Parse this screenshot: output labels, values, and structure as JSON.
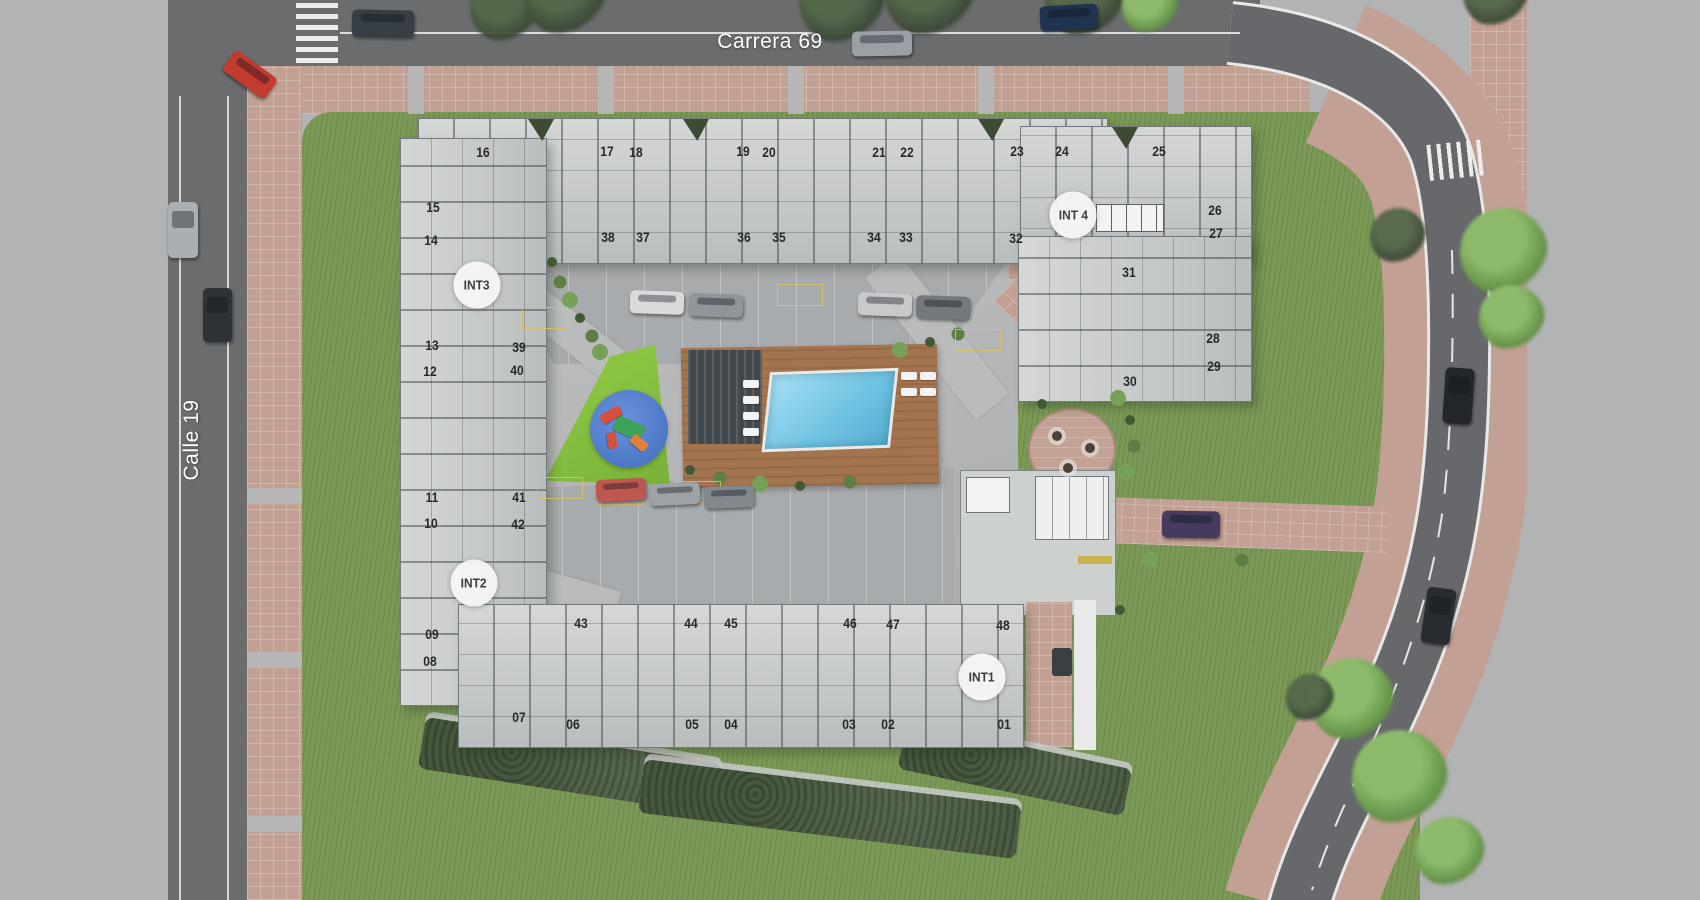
{
  "streets": {
    "top_label": "Carrera 69",
    "left_label": "Calle 19"
  },
  "int_markers": [
    {
      "label": "INT3",
      "x": 477,
      "y": 285
    },
    {
      "label": "INT 4",
      "x": 1073,
      "y": 215
    },
    {
      "label": "INT2",
      "x": 474,
      "y": 583
    },
    {
      "label": "INT1",
      "x": 982,
      "y": 677
    }
  ],
  "units": [
    {
      "n": "16",
      "x": 483,
      "y": 152
    },
    {
      "n": "17",
      "x": 607,
      "y": 151
    },
    {
      "n": "18",
      "x": 636,
      "y": 152
    },
    {
      "n": "19",
      "x": 743,
      "y": 151
    },
    {
      "n": "20",
      "x": 769,
      "y": 152
    },
    {
      "n": "21",
      "x": 879,
      "y": 152
    },
    {
      "n": "22",
      "x": 907,
      "y": 152
    },
    {
      "n": "23",
      "x": 1017,
      "y": 151
    },
    {
      "n": "24",
      "x": 1062,
      "y": 151
    },
    {
      "n": "25",
      "x": 1159,
      "y": 151
    },
    {
      "n": "38",
      "x": 608,
      "y": 237
    },
    {
      "n": "37",
      "x": 643,
      "y": 237
    },
    {
      "n": "36",
      "x": 744,
      "y": 237
    },
    {
      "n": "35",
      "x": 779,
      "y": 237
    },
    {
      "n": "34",
      "x": 874,
      "y": 237
    },
    {
      "n": "33",
      "x": 906,
      "y": 237
    },
    {
      "n": "32",
      "x": 1016,
      "y": 238
    },
    {
      "n": "26",
      "x": 1215,
      "y": 210
    },
    {
      "n": "27",
      "x": 1216,
      "y": 233
    },
    {
      "n": "31",
      "x": 1129,
      "y": 272
    },
    {
      "n": "28",
      "x": 1213,
      "y": 338
    },
    {
      "n": "29",
      "x": 1214,
      "y": 366
    },
    {
      "n": "30",
      "x": 1130,
      "y": 381
    },
    {
      "n": "15",
      "x": 433,
      "y": 207
    },
    {
      "n": "14",
      "x": 431,
      "y": 240
    },
    {
      "n": "13",
      "x": 432,
      "y": 345
    },
    {
      "n": "12",
      "x": 430,
      "y": 371
    },
    {
      "n": "39",
      "x": 519,
      "y": 347
    },
    {
      "n": "40",
      "x": 517,
      "y": 370
    },
    {
      "n": "11",
      "x": 432,
      "y": 497
    },
    {
      "n": "10",
      "x": 431,
      "y": 523
    },
    {
      "n": "41",
      "x": 519,
      "y": 497
    },
    {
      "n": "42",
      "x": 518,
      "y": 524
    },
    {
      "n": "09",
      "x": 432,
      "y": 634
    },
    {
      "n": "08",
      "x": 430,
      "y": 661
    },
    {
      "n": "43",
      "x": 581,
      "y": 623
    },
    {
      "n": "44",
      "x": 691,
      "y": 623
    },
    {
      "n": "45",
      "x": 731,
      "y": 623
    },
    {
      "n": "46",
      "x": 850,
      "y": 623
    },
    {
      "n": "47",
      "x": 893,
      "y": 624
    },
    {
      "n": "48",
      "x": 1003,
      "y": 625
    },
    {
      "n": "07",
      "x": 519,
      "y": 717
    },
    {
      "n": "06",
      "x": 573,
      "y": 724
    },
    {
      "n": "05",
      "x": 692,
      "y": 724
    },
    {
      "n": "04",
      "x": 731,
      "y": 724
    },
    {
      "n": "03",
      "x": 849,
      "y": 724
    },
    {
      "n": "02",
      "x": 888,
      "y": 724
    },
    {
      "n": "01",
      "x": 1004,
      "y": 724
    }
  ],
  "cars": [
    {
      "x": 352,
      "y": 10,
      "w": 62,
      "h": 27,
      "r": 1,
      "c": "#383e45"
    },
    {
      "x": 852,
      "y": 31,
      "w": 60,
      "h": 25,
      "r": -1,
      "c": "#9aa0a5"
    },
    {
      "x": 1040,
      "y": 5,
      "w": 58,
      "h": 25,
      "r": -3,
      "c": "#20334f"
    },
    {
      "x": 224,
      "y": 62,
      "w": 52,
      "h": 25,
      "r": 36,
      "c": "#c23b2e"
    },
    {
      "x": 168,
      "y": 202,
      "w": 30,
      "h": 56,
      "r": 0,
      "c": "#a9afb3"
    },
    {
      "x": 203,
      "y": 288,
      "w": 29,
      "h": 54,
      "r": 0,
      "c": "#2d3237"
    },
    {
      "x": 1444,
      "y": 368,
      "w": 29,
      "h": 56,
      "r": 4,
      "c": "#23272b"
    },
    {
      "x": 1424,
      "y": 588,
      "w": 29,
      "h": 56,
      "r": 8,
      "c": "#282c31"
    },
    {
      "x": 1162,
      "y": 511,
      "w": 58,
      "h": 27,
      "r": 1,
      "c": "#463b5e"
    },
    {
      "x": 630,
      "y": 291,
      "w": 54,
      "h": 23,
      "r": 2,
      "c": "#d8dadb"
    },
    {
      "x": 689,
      "y": 294,
      "w": 54,
      "h": 23,
      "r": 2,
      "c": "#8f9599"
    },
    {
      "x": 858,
      "y": 293,
      "w": 54,
      "h": 23,
      "r": 2,
      "c": "#c7c9cb"
    },
    {
      "x": 916,
      "y": 296,
      "w": 54,
      "h": 23,
      "r": 2,
      "c": "#75797d"
    },
    {
      "x": 596,
      "y": 479,
      "w": 50,
      "h": 22,
      "r": -3,
      "c": "#bf5750"
    },
    {
      "x": 650,
      "y": 483,
      "w": 50,
      "h": 22,
      "r": -3,
      "c": "#9ea3a7"
    },
    {
      "x": 704,
      "y": 486,
      "w": 50,
      "h": 22,
      "r": -2,
      "c": "#83888c"
    }
  ],
  "trees": [
    {
      "x": 505,
      "y": 8,
      "s": 70,
      "t": "dark"
    },
    {
      "x": 565,
      "y": -6,
      "s": 84,
      "t": "dark"
    },
    {
      "x": 842,
      "y": 2,
      "s": 86,
      "t": "dark"
    },
    {
      "x": 930,
      "y": -8,
      "s": 92,
      "t": "dark"
    },
    {
      "x": 1085,
      "y": -2,
      "s": 80,
      "t": "dark"
    },
    {
      "x": 1150,
      "y": 6,
      "s": 56,
      "t": "light"
    },
    {
      "x": 1496,
      "y": -6,
      "s": 66,
      "t": "dark"
    },
    {
      "x": 1504,
      "y": 252,
      "s": 88,
      "t": "light"
    },
    {
      "x": 1512,
      "y": 318,
      "s": 66,
      "t": "light"
    },
    {
      "x": 1398,
      "y": 236,
      "s": 56,
      "t": "dark"
    },
    {
      "x": 1352,
      "y": 700,
      "s": 84,
      "t": "light"
    },
    {
      "x": 1400,
      "y": 778,
      "s": 96,
      "t": "light"
    },
    {
      "x": 1310,
      "y": 698,
      "s": 48,
      "t": "dark"
    },
    {
      "x": 1450,
      "y": 852,
      "s": 70,
      "t": "light"
    }
  ],
  "shrubs": [
    [
      552,
      262
    ],
    [
      560,
      282
    ],
    [
      570,
      300
    ],
    [
      580,
      318
    ],
    [
      592,
      336
    ],
    [
      600,
      352
    ],
    [
      690,
      470
    ],
    [
      720,
      478
    ],
    [
      760,
      484
    ],
    [
      800,
      486
    ],
    [
      850,
      482
    ],
    [
      900,
      350
    ],
    [
      930,
      342
    ],
    [
      958,
      334
    ],
    [
      1118,
      398
    ],
    [
      1130,
      420
    ],
    [
      1134,
      446
    ],
    [
      1126,
      472
    ],
    [
      1042,
      404
    ],
    [
      1242,
      560
    ],
    [
      1150,
      560
    ],
    [
      1120,
      610
    ]
  ],
  "stalls": [
    [
      545,
      318
    ],
    [
      800,
      295
    ],
    [
      978,
      340
    ],
    [
      620,
      494
    ],
    [
      698,
      492
    ],
    [
      560,
      488
    ]
  ],
  "loungers": [
    [
      743,
      380
    ],
    [
      743,
      396
    ],
    [
      743,
      412
    ],
    [
      743,
      428
    ],
    [
      901,
      372
    ],
    [
      920,
      372
    ],
    [
      901,
      388
    ],
    [
      920,
      388
    ]
  ],
  "terrace_tables": [
    [
      1057,
      436
    ],
    [
      1090,
      448
    ],
    [
      1068,
      468
    ]
  ],
  "colors": {
    "canvas": "#b2b3b5",
    "asphalt": "#6a6c6e",
    "sidewalk": "#c3a094",
    "grass": "#7c9a57",
    "play_blue": "#5a85d1",
    "pool": "#7ccbe8",
    "deck": "#a3744e",
    "building": "#c3c6c6",
    "lot": "#a8abad",
    "court": "#b5b7b9",
    "hedge": "#45573c",
    "label": "#26292c",
    "marker_bg": "#f4f5f3",
    "road_line": "#e8e8e8"
  }
}
